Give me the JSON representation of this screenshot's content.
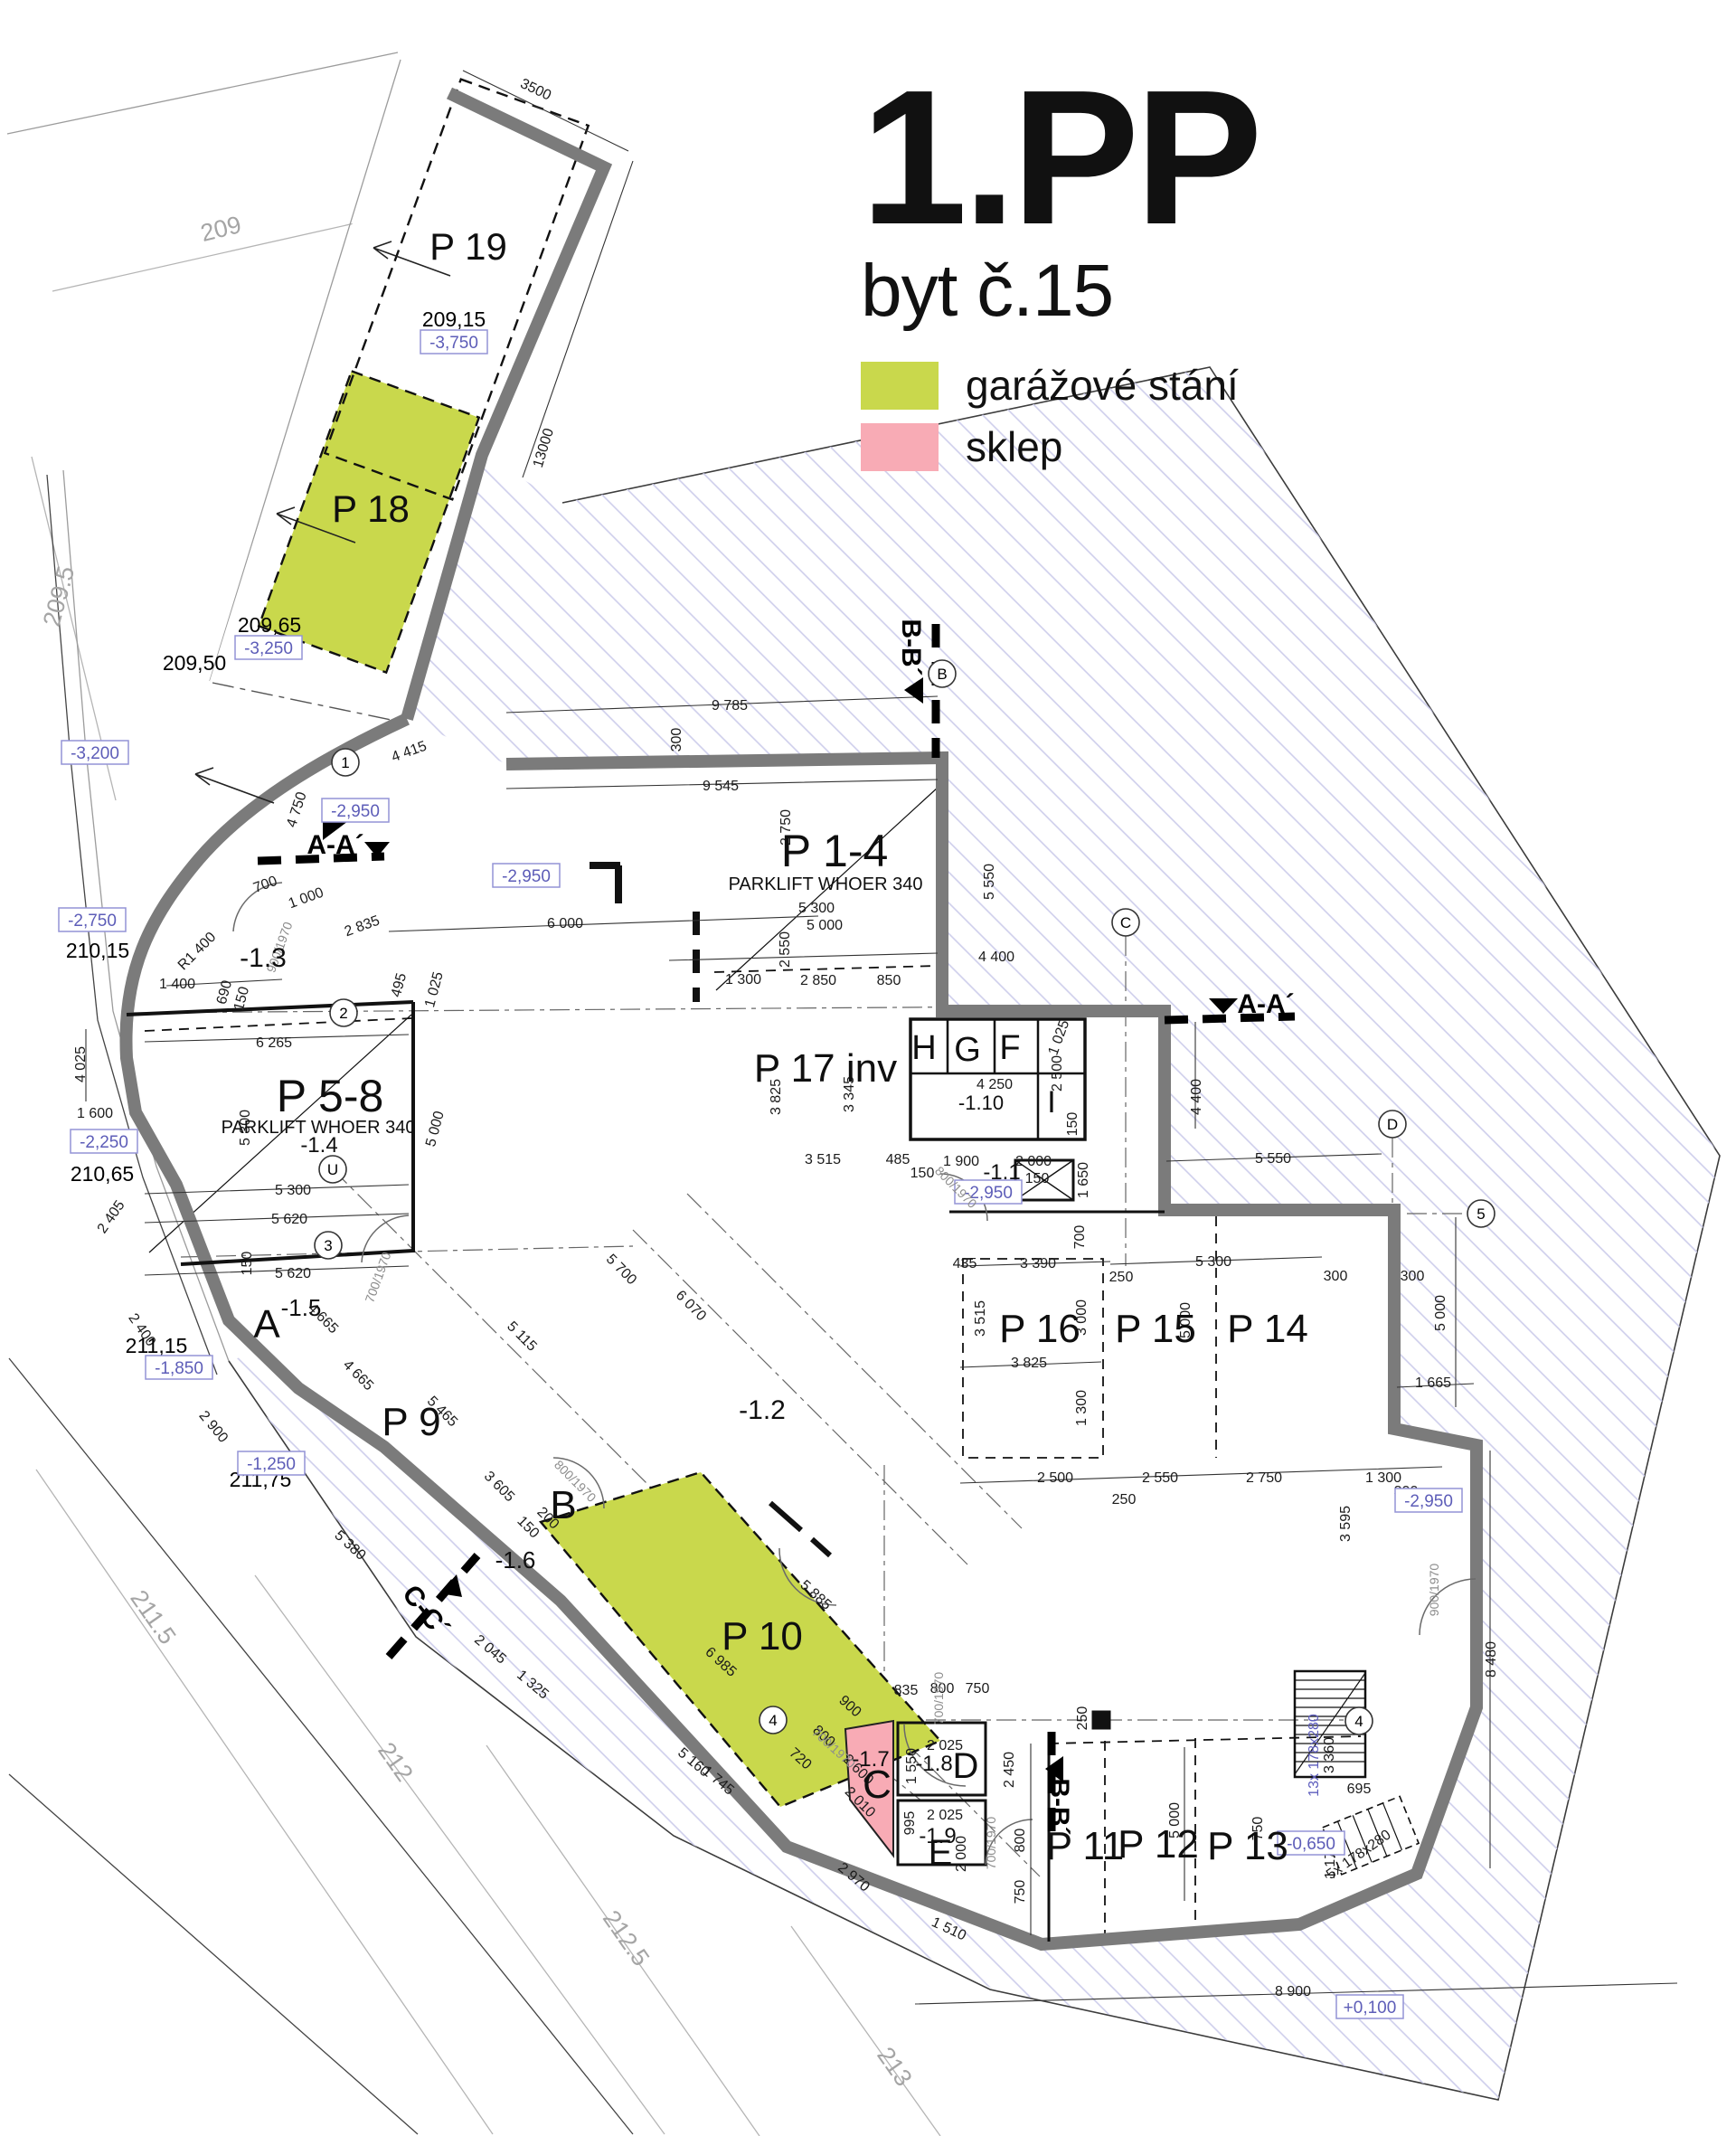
{
  "title": {
    "main": "1.PP",
    "sub": "byt č.15"
  },
  "legend": {
    "items": [
      {
        "label": "garážové stání",
        "color": "#c9d84c"
      },
      {
        "label": "sklep",
        "color": "#f8abb5"
      }
    ]
  },
  "colors": {
    "wall": "#7b7b7b",
    "hatch": "#cdcdeb",
    "garage_highlight": "#c9d84c",
    "cellar_highlight": "#f8abb5",
    "level_box": "#5d5db8"
  },
  "plan": {
    "rooms": [
      [
        518,
        281,
        0,
        "P 19",
        42
      ],
      [
        410,
        571,
        0,
        "P 18",
        42
      ],
      [
        923,
        952,
        0,
        "P 1-4",
        50
      ],
      [
        365,
        1223,
        0,
        "P 5-8",
        50
      ],
      [
        913,
        1190,
        0,
        "P 17 inv",
        44
      ],
      [
        455,
        1581,
        0,
        "P 9",
        44
      ],
      [
        843,
        1818,
        0,
        "P 10",
        44
      ],
      [
        1200,
        2050,
        0,
        "P 11",
        44
      ],
      [
        1281,
        2048,
        0,
        "P 12",
        44
      ],
      [
        1380,
        2050,
        0,
        "P 13",
        44
      ],
      [
        1402,
        1478,
        0,
        "P 14",
        44
      ],
      [
        1278,
        1478,
        0,
        "P 15",
        44
      ],
      [
        1150,
        1478,
        0,
        "P 16",
        44
      ],
      [
        295,
        1473,
        0,
        "A",
        44
      ],
      [
        623,
        1673,
        0,
        "B",
        44
      ],
      [
        970,
        1982,
        0,
        "C",
        44
      ],
      [
        1068,
        1960,
        0,
        "D",
        40
      ],
      [
        1040,
        2056,
        0,
        "E",
        40
      ],
      [
        1117,
        1165,
        0,
        "F",
        38
      ],
      [
        1070,
        1167,
        0,
        "G",
        38
      ],
      [
        1022,
        1165,
        0,
        "H",
        38
      ],
      [
        1163,
        1224,
        0,
        "I",
        34
      ],
      [
        333,
        1449,
        0,
        "-1.5",
        26
      ],
      [
        570,
        1728,
        0,
        "-1.6",
        26
      ],
      [
        963,
        1947,
        0,
        "-1.7",
        24
      ],
      [
        1033,
        1952,
        0,
        "-1.8",
        24
      ],
      [
        1037,
        2032,
        0,
        "-1.9",
        24
      ],
      [
        1085,
        1221,
        0,
        "-1.10",
        22
      ],
      [
        1108,
        1298,
        0,
        "-1.1",
        24
      ],
      [
        353,
        1268,
        0,
        "-1.4",
        24
      ],
      [
        843,
        1563,
        0,
        "-1.2",
        30
      ],
      [
        291,
        1063,
        0,
        "-1.3",
        30
      ]
    ],
    "subs": [
      [
        913,
        978,
        0,
        "PARKLIFT WHOER 340",
        20
      ],
      [
        352,
        1247,
        0,
        "PARKLIFT WHOER 340",
        20
      ]
    ],
    "sections": [
      [
        371,
        938,
        0,
        "A-A´"
      ],
      [
        1400,
        1114,
        0,
        "A-A´"
      ],
      [
        1004,
        716,
        90,
        "B-B´"
      ],
      [
        1168,
        1998,
        90,
        "B-B´"
      ],
      [
        468,
        1784,
        52,
        "C-C´"
      ]
    ],
    "bubbles": [
      [
        382,
        843,
        0,
        "1"
      ],
      [
        380,
        1120,
        0,
        "2"
      ],
      [
        363,
        1377,
        0,
        "3"
      ],
      [
        368,
        1293,
        0,
        "U"
      ],
      [
        1042,
        745,
        0,
        "B"
      ],
      [
        1245,
        1020,
        0,
        "C"
      ],
      [
        1540,
        1243,
        0,
        "D"
      ],
      [
        1638,
        1342,
        0,
        "5"
      ],
      [
        855,
        1902,
        0,
        "4"
      ],
      [
        1503,
        1903,
        0,
        "4"
      ]
    ],
    "levels_plain": [
      [
        502,
        355,
        0,
        "209,15"
      ],
      [
        298,
        693,
        0,
        "209,65"
      ],
      [
        215,
        735,
        0,
        "209,50"
      ],
      [
        108,
        1053,
        0,
        "210,15"
      ],
      [
        113,
        1300,
        0,
        "210,65"
      ],
      [
        173,
        1490,
        0,
        "211,15"
      ],
      [
        288,
        1638,
        0,
        "211,75"
      ]
    ],
    "levels_boxed": [
      [
        502,
        378,
        0,
        "-3,750"
      ],
      [
        297,
        716,
        0,
        "-3,250"
      ],
      [
        105,
        832,
        0,
        "-3,200"
      ],
      [
        102,
        1017,
        0,
        "-2,750"
      ],
      [
        115,
        1262,
        0,
        "-2,250"
      ],
      [
        198,
        1512,
        0,
        "-1,850"
      ],
      [
        300,
        1618,
        0,
        "-1,250"
      ],
      [
        393,
        896,
        0,
        "-2,950"
      ],
      [
        582,
        968,
        0,
        "-2,950"
      ],
      [
        1093,
        1318,
        0,
        "-2,950"
      ],
      [
        1580,
        1659,
        0,
        "-2,950"
      ],
      [
        1450,
        2038,
        0,
        "-0,650"
      ],
      [
        1515,
        2219,
        0,
        "+0,100"
      ]
    ],
    "contours": [
      [
        245,
        256,
        -14,
        "209"
      ],
      [
        68,
        660,
        -75,
        "209.5"
      ],
      [
        167,
        1790,
        55,
        "211.5"
      ],
      [
        435,
        1950,
        55,
        "212"
      ],
      [
        690,
        2145,
        55,
        "212.5"
      ],
      [
        987,
        2287,
        55,
        "213"
      ]
    ],
    "doors": [
      [
        308,
        1047,
        -70,
        "900/1970"
      ],
      [
        417,
        1412,
        -70,
        "700/1970"
      ],
      [
        637,
        1637,
        45,
        "800/1970"
      ],
      [
        1037,
        1878,
        -90,
        "700/1970"
      ],
      [
        923,
        1932,
        42,
        "700/1970"
      ],
      [
        1095,
        2038,
        -90,
        "700/1970"
      ],
      [
        1058,
        1312,
        45,
        "800/1970"
      ],
      [
        1585,
        1758,
        -90,
        "900/1970"
      ]
    ],
    "dims_blue": [
      [
        1452,
        1941,
        -90,
        "13x 178x280"
      ]
    ],
    "dims": [
      [
        593,
        98,
        25,
        "3500"
      ],
      [
        600,
        495,
        -73,
        "13000"
      ],
      [
        807,
        779,
        0,
        "9 785"
      ],
      [
        747,
        818,
        -90,
        "300"
      ],
      [
        797,
        868,
        0,
        "9 545"
      ],
      [
        868,
        915,
        -90,
        "2 750"
      ],
      [
        903,
        1003,
        0,
        "5 300"
      ],
      [
        912,
        1022,
        0,
        "5 000"
      ],
      [
        867,
        1050,
        -90,
        "2 550"
      ],
      [
        822,
        1082,
        0,
        "1 300"
      ],
      [
        905,
        1083,
        0,
        "2 850"
      ],
      [
        983,
        1083,
        0,
        "850"
      ],
      [
        625,
        1020,
        0,
        "6 000"
      ],
      [
        400,
        1023,
        -20,
        "2 835"
      ],
      [
        452,
        830,
        -20,
        "4 415"
      ],
      [
        327,
        895,
        -72,
        "4 750"
      ],
      [
        293,
        977,
        -20,
        "700"
      ],
      [
        338,
        992,
        -20,
        "1 000"
      ],
      [
        217,
        1051,
        -45,
        "R1 400"
      ],
      [
        196,
        1087,
        0,
        "1 400"
      ],
      [
        247,
        1097,
        -75,
        "690"
      ],
      [
        266,
        1104,
        -75,
        "150"
      ],
      [
        440,
        1089,
        -75,
        "495"
      ],
      [
        479,
        1094,
        -75,
        "1 025"
      ],
      [
        88,
        1177,
        -90,
        "4 025"
      ],
      [
        105,
        1230,
        0,
        "1 600"
      ],
      [
        122,
        1345,
        -55,
        "2 405"
      ],
      [
        303,
        1152,
        0,
        "6 265"
      ],
      [
        270,
        1247,
        -90,
        "5 300"
      ],
      [
        324,
        1315,
        0,
        "5 300"
      ],
      [
        320,
        1347,
        0,
        "5 620"
      ],
      [
        272,
        1397,
        -90,
        "150"
      ],
      [
        324,
        1407,
        0,
        "5 620"
      ],
      [
        480,
        1248,
        -75,
        "5 000"
      ],
      [
        1093,
        975,
        -90,
        "5 550"
      ],
      [
        1102,
        1057,
        0,
        "4 400"
      ],
      [
        1322,
        1213,
        -90,
        "4 400"
      ],
      [
        1408,
        1280,
        0,
        "5 550"
      ],
      [
        857,
        1213,
        -90,
        "3 825"
      ],
      [
        938,
        1210,
        -90,
        "3 345"
      ],
      [
        910,
        1281,
        0,
        "3 515"
      ],
      [
        993,
        1281,
        0,
        "485"
      ],
      [
        1063,
        1283,
        0,
        "1 900"
      ],
      [
        1143,
        1283,
        0,
        "2 000"
      ],
      [
        1020,
        1296,
        0,
        "150"
      ],
      [
        1147,
        1302,
        0,
        "150"
      ],
      [
        1170,
        1147,
        -70,
        "1 025"
      ],
      [
        1100,
        1198,
        0,
        "4 250"
      ],
      [
        1168,
        1187,
        -90,
        "2 500"
      ],
      [
        1185,
        1243,
        -90,
        "150"
      ],
      [
        1197,
        1305,
        -90,
        "1 650"
      ],
      [
        1067,
        1396,
        0,
        "435"
      ],
      [
        1148,
        1396,
        0,
        "3 390"
      ],
      [
        1342,
        1394,
        0,
        "5 300"
      ],
      [
        1477,
        1410,
        0,
        "300"
      ],
      [
        1193,
        1368,
        -90,
        "700"
      ],
      [
        1240,
        1411,
        0,
        "250"
      ],
      [
        1083,
        1458,
        -90,
        "3 515"
      ],
      [
        1195,
        1457,
        -90,
        "3 000"
      ],
      [
        1310,
        1460,
        -90,
        "5 000"
      ],
      [
        1592,
        1452,
        -90,
        "5 000"
      ],
      [
        1138,
        1506,
        0,
        "3 825"
      ],
      [
        1195,
        1557,
        -90,
        "1 300"
      ],
      [
        1585,
        1528,
        0,
        "1 665"
      ],
      [
        1167,
        1633,
        0,
        "2 500"
      ],
      [
        1283,
        1633,
        0,
        "2 550"
      ],
      [
        1398,
        1633,
        0,
        "2 750"
      ],
      [
        1530,
        1633,
        0,
        "1 300"
      ],
      [
        1243,
        1657,
        0,
        "250"
      ],
      [
        1555,
        1648,
        0,
        "300"
      ],
      [
        1487,
        1685,
        -90,
        "3 595"
      ],
      [
        1648,
        1835,
        -90,
        "8 480"
      ],
      [
        688,
        1403,
        45,
        "5 700"
      ],
      [
        765,
        1443,
        45,
        "6 070"
      ],
      [
        358,
        1457,
        45,
        "4 665"
      ],
      [
        397,
        1520,
        45,
        "4 665"
      ],
      [
        490,
        1560,
        45,
        "5 465"
      ],
      [
        553,
        1643,
        45,
        "3 605"
      ],
      [
        578,
        1477,
        45,
        "5 115"
      ],
      [
        158,
        1470,
        55,
        "2 400"
      ],
      [
        237,
        1577,
        50,
        "2 900"
      ],
      [
        388,
        1708,
        42,
        "5 380"
      ],
      [
        543,
        1823,
        40,
        "2 045"
      ],
      [
        590,
        1862,
        40,
        "1 325"
      ],
      [
        585,
        1688,
        45,
        "150"
      ],
      [
        607,
        1678,
        45,
        "200"
      ],
      [
        903,
        1763,
        42,
        "5 885"
      ],
      [
        798,
        1837,
        42,
        "6 985"
      ],
      [
        941,
        1886,
        42,
        "900"
      ],
      [
        912,
        1919,
        42,
        "800"
      ],
      [
        886,
        1944,
        42,
        "720"
      ],
      [
        768,
        1948,
        40,
        "5 160"
      ],
      [
        795,
        1968,
        40,
        "1 745"
      ],
      [
        945,
        2075,
        40,
        "2 970"
      ],
      [
        1050,
        2132,
        25,
        "1 510"
      ],
      [
        1002,
        1868,
        0,
        "835"
      ],
      [
        1042,
        1866,
        0,
        "800"
      ],
      [
        1081,
        1866,
        0,
        "750"
      ],
      [
        1045,
        1929,
        0,
        "2 025"
      ],
      [
        1007,
        1953,
        -90,
        "1 550"
      ],
      [
        1045,
        2006,
        0,
        "2 025"
      ],
      [
        1005,
        2016,
        -90,
        "995"
      ],
      [
        1062,
        2050,
        -90,
        "2 000"
      ],
      [
        950,
        1956,
        45,
        "2 600"
      ],
      [
        952,
        1992,
        45,
        "2 010"
      ],
      [
        1115,
        1957,
        -90,
        "2 450"
      ],
      [
        1127,
        2035,
        -90,
        "800"
      ],
      [
        1127,
        2092,
        -90,
        "750"
      ],
      [
        1196,
        1900,
        -90,
        "250"
      ],
      [
        1298,
        2013,
        -90,
        "5 000"
      ],
      [
        1390,
        2022,
        -90,
        "750"
      ],
      [
        1430,
        2201,
        0,
        "8 900"
      ],
      [
        1469,
        1941,
        -90,
        "3 360"
      ],
      [
        1503,
        1977,
        0,
        "695"
      ],
      [
        1502,
        2050,
        -35,
        "5x 178x280"
      ],
      [
        1470,
        2058,
        -90,
        "1 175"
      ],
      [
        1562,
        1410,
        0,
        "300"
      ]
    ]
  }
}
